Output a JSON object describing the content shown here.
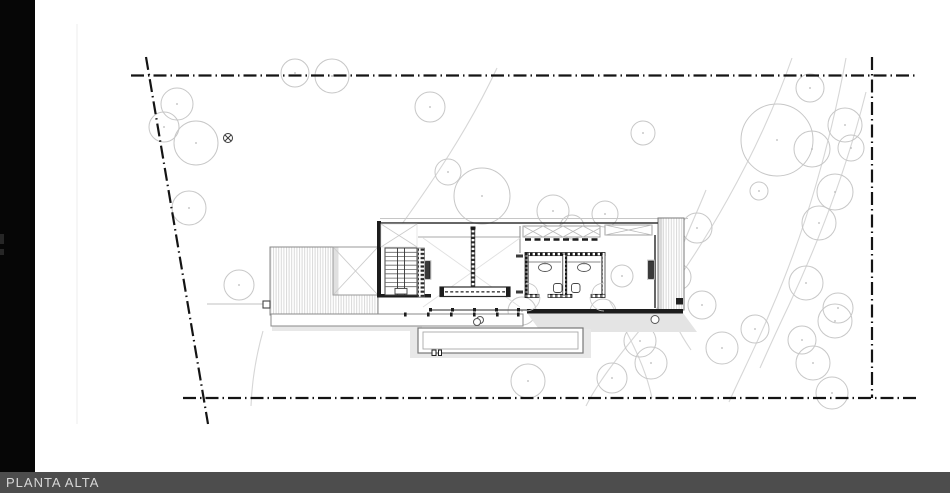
{
  "titlebar": {
    "label": "PLANTA ALTA"
  },
  "colors": {
    "background": "#ffffff",
    "boundary": "#141414",
    "wall_dark": "#1c1c1c",
    "line_medium": "#555555",
    "line_light": "#999999",
    "tree": "#c7c7c7",
    "tree_center": "#b8b8b8",
    "contour": "#d6d6d6",
    "shadow": "#e4e4e4",
    "sidebar": "#060606",
    "titlebar_bg": "#4d4d4d",
    "titlebar_text": "#d8d8d8"
  },
  "drawing": {
    "boundary_style": "dash-dot",
    "trees": [
      [
        177,
        104,
        16
      ],
      [
        164,
        127,
        15
      ],
      [
        196,
        143,
        22
      ],
      [
        189,
        208,
        17
      ],
      [
        239,
        285,
        15
      ],
      [
        295,
        73,
        14
      ],
      [
        332,
        76,
        17
      ],
      [
        430,
        107,
        15
      ],
      [
        448,
        172,
        13
      ],
      [
        482,
        196,
        28
      ],
      [
        553,
        211,
        16
      ],
      [
        572,
        227,
        12
      ],
      [
        605,
        214,
        13
      ],
      [
        643,
        133,
        12
      ],
      [
        697,
        228,
        15
      ],
      [
        678,
        277,
        13
      ],
      [
        702,
        305,
        14
      ],
      [
        759,
        191,
        9
      ],
      [
        777,
        140,
        36
      ],
      [
        810,
        88,
        14
      ],
      [
        845,
        125,
        17
      ],
      [
        851,
        148,
        13
      ],
      [
        812,
        149,
        18
      ],
      [
        835,
        192,
        18
      ],
      [
        819,
        223,
        17
      ],
      [
        806,
        283,
        17
      ],
      [
        838,
        308,
        15
      ],
      [
        522,
        311,
        14
      ],
      [
        603,
        312,
        13
      ],
      [
        622,
        276,
        11
      ],
      [
        528,
        381,
        17
      ],
      [
        612,
        378,
        15
      ],
      [
        640,
        341,
        16
      ],
      [
        651,
        363,
        16
      ],
      [
        722,
        348,
        16
      ],
      [
        755,
        329,
        14
      ],
      [
        802,
        340,
        14
      ],
      [
        813,
        363,
        17
      ],
      [
        835,
        321,
        17
      ],
      [
        832,
        393,
        16
      ]
    ],
    "contours": [
      "M497,68 C468,130 430,185 402,224",
      "M263,331 C256,356 252,380 251,406",
      "M792,58 C760,150 703,252 640,330 C616,359 597,384 586,406",
      "M846,58 C831,140 806,230 771,310 C757,344 741,375 729,402",
      "M866,92 C847,168 818,243 789,305 C778,328 768,350 760,368",
      "M706,190 C690,230 669,268 670,300 C671,318 680,334 691,350",
      "M609,300 C626,330 645,364 652,398"
    ],
    "symbols": [
      {
        "name": "circled-x",
        "x": 228,
        "y": 138,
        "r": 4.5
      }
    ]
  }
}
